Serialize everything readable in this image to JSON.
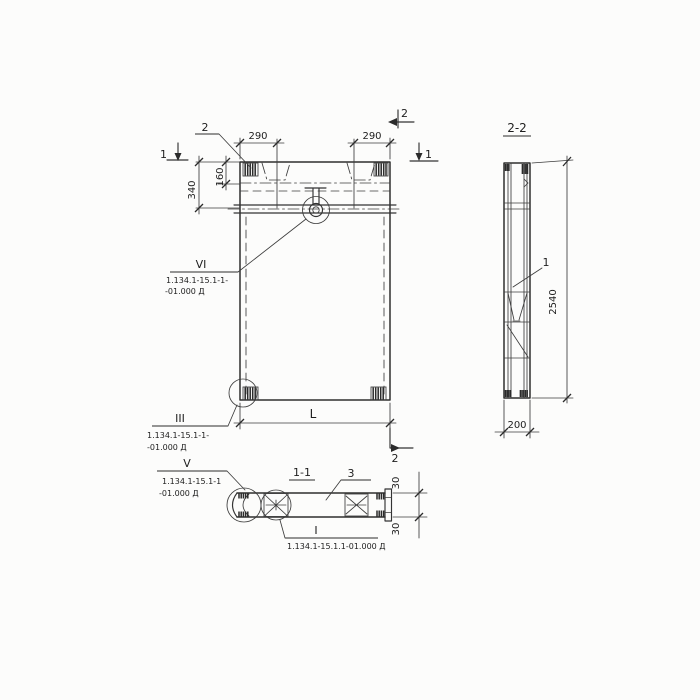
{
  "drawing": {
    "ink_color": "#2e2e2e",
    "paper_color": "#fcfcfb",
    "front_view": {
      "callout_2": "2",
      "section_mark_1_left": "1",
      "section_mark_1_right": "1",
      "section_mark_2_top": "2",
      "section_mark_2_bottom": "2",
      "dim_290_left": "290",
      "dim_290_right": "290",
      "dim_340": "340",
      "dim_160": "160",
      "dim_length": "L",
      "detail_vi": {
        "label": "VI",
        "ref_line1": "1.134.1-15.1-1-",
        "ref_line2": "-01.000 Д"
      },
      "detail_iii": {
        "label": "III",
        "ref_line1": "1.134.1-15.1-1-",
        "ref_line2": "-01.000 Д"
      }
    },
    "side_view": {
      "title": "2-2",
      "callout_1": "1",
      "dim_height": "2540",
      "dim_width": "200"
    },
    "section_view": {
      "title": "1-1",
      "callout_3": "3",
      "dim_30_top": "30",
      "dim_30_bottom": "30",
      "detail_v": {
        "label": "V",
        "ref_line1": "1.134.1-15.1-1",
        "ref_line2": "-01.000 Д"
      },
      "detail_i": {
        "label": "I",
        "ref": "1.134.1-15.1.1-01.000 Д"
      }
    }
  }
}
